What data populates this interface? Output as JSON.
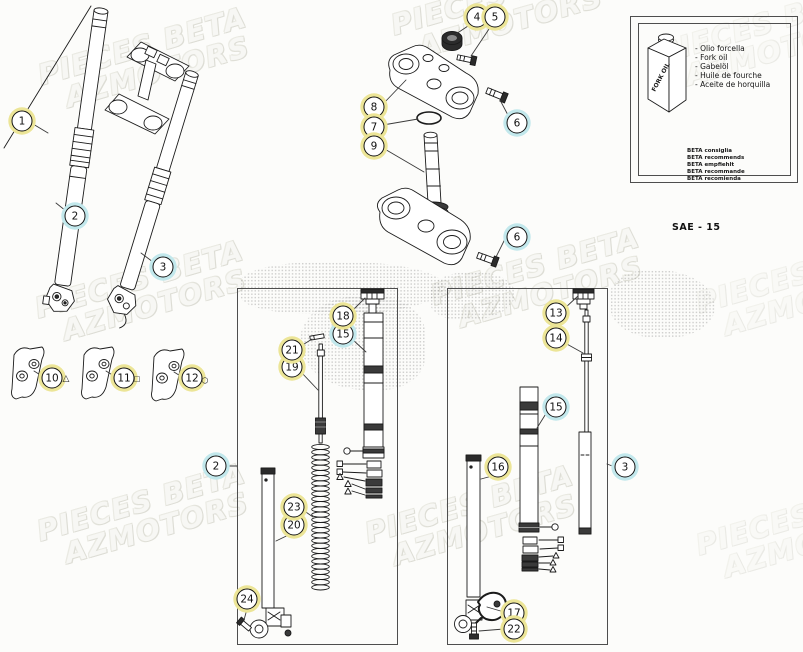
{
  "watermark": {
    "line1": "PIECES BETA",
    "line2": "AZMOTORS"
  },
  "callouts": {
    "c1": "1",
    "c2": "2",
    "c3": "3",
    "c4": "4",
    "c5": "5",
    "c6": "6",
    "c7": "7",
    "c8": "8",
    "c9": "9",
    "c10": "10",
    "c11": "11",
    "c12": "12",
    "c13": "13",
    "c14": "14",
    "c15": "15",
    "c16": "16",
    "c17": "17",
    "c18": "18",
    "c19": "19",
    "c20": "20",
    "c21": "21",
    "c22": "22",
    "c23": "23",
    "c24": "24"
  },
  "symbols": {
    "triangle": "△",
    "square": "□",
    "circle": "○"
  },
  "oil_box": {
    "bottle_label": "FORK OIL",
    "names": [
      "- Olio forcella",
      "- Fork oil",
      "- Gabelöl",
      "- Huile de fourche",
      "- Aceite de horquilla"
    ],
    "recommendations": [
      "BETA consiglia",
      "BETA recommends",
      "BETA empfiehlt",
      "BETA recommande",
      "BETA recomienda"
    ],
    "grade": "SAE - 15"
  },
  "colors": {
    "callout_yellow": "#ece597",
    "callout_cyan": "#c2e8ec",
    "line": "#1b1b1b",
    "watermark_outline": "#dcdcd4"
  }
}
